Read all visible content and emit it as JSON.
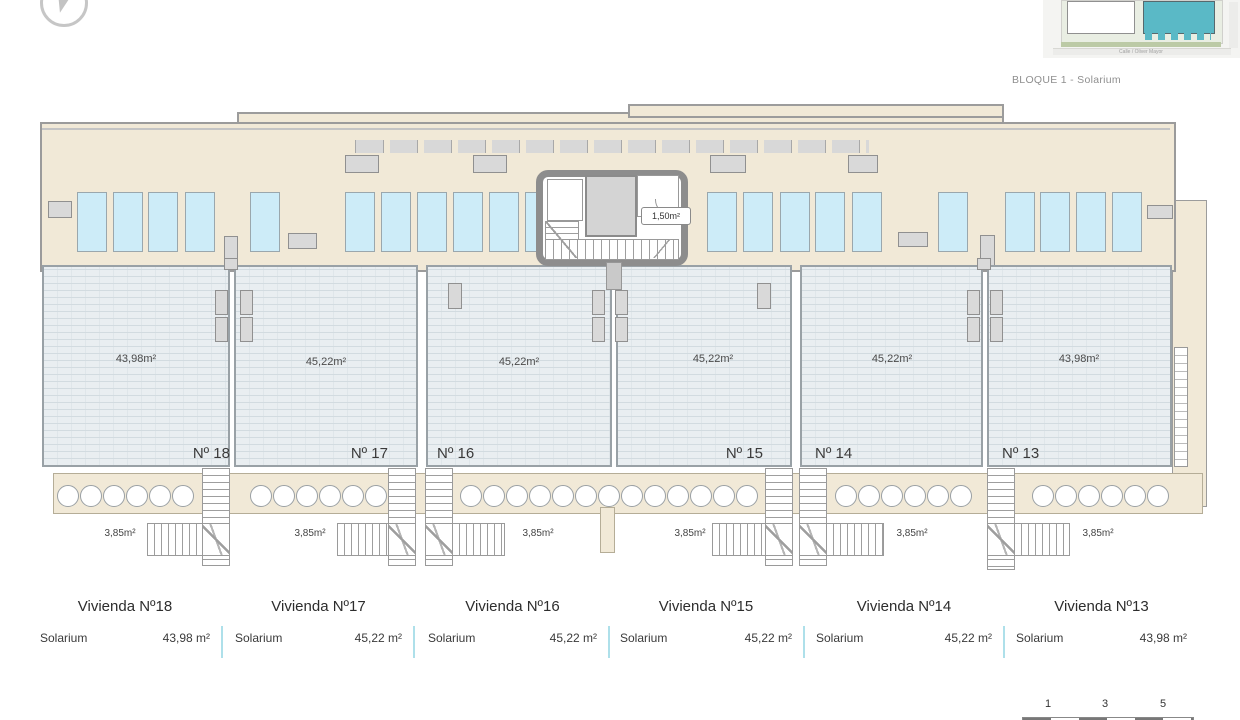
{
  "header": {
    "compass_icon": "compass-icon",
    "block_label": "BLOQUE 1 - Solarium",
    "minimap": {
      "street_label": "Calle / Oliver Mayor"
    }
  },
  "plan": {
    "stairwell": {
      "storage_area": "1,50m²"
    },
    "units": [
      {
        "number": "Nº 18",
        "area": "43,98m²",
        "stair_area": "3,85m²"
      },
      {
        "number": "Nº 17",
        "area": "45,22m²",
        "stair_area": "3,85m²"
      },
      {
        "number": "Nº 16",
        "area": "45,22m²",
        "stair_area": "3,85m²"
      },
      {
        "number": "Nº 15",
        "area": "45,22m²",
        "stair_area": "3,85m²"
      },
      {
        "number": "Nº 14",
        "area": "45,22m²",
        "stair_area": "3,85m²"
      },
      {
        "number": "Nº 13",
        "area": "43,98m²",
        "stair_area": "3,85m²"
      }
    ]
  },
  "legend": {
    "items": [
      {
        "title": "Vivienda Nº18",
        "row_label": "Solarium",
        "value": "43,98 m²"
      },
      {
        "title": "Vivienda Nº17",
        "row_label": "Solarium",
        "value": "45,22 m²"
      },
      {
        "title": "Vivienda Nº16",
        "row_label": "Solarium",
        "value": "45,22 m²"
      },
      {
        "title": "Vivienda Nº15",
        "row_label": "Solarium",
        "value": "45,22 m²"
      },
      {
        "title": "Vivienda Nº14",
        "row_label": "Solarium",
        "value": "45,22 m²"
      },
      {
        "title": "Vivienda Nº13",
        "row_label": "Solarium",
        "value": "43,98 m²"
      }
    ]
  },
  "scalebar": {
    "ticks": [
      "1",
      "3",
      "5"
    ]
  },
  "colors": {
    "accent_teal": "#5ab9c6",
    "deck_beige": "#f1e9d7",
    "terrace_hatch": "#e9eef1",
    "wall_gray": "#9b9b9b",
    "sunbed_blue": "#cdecf8",
    "legend_divider": "#aee0ea"
  }
}
